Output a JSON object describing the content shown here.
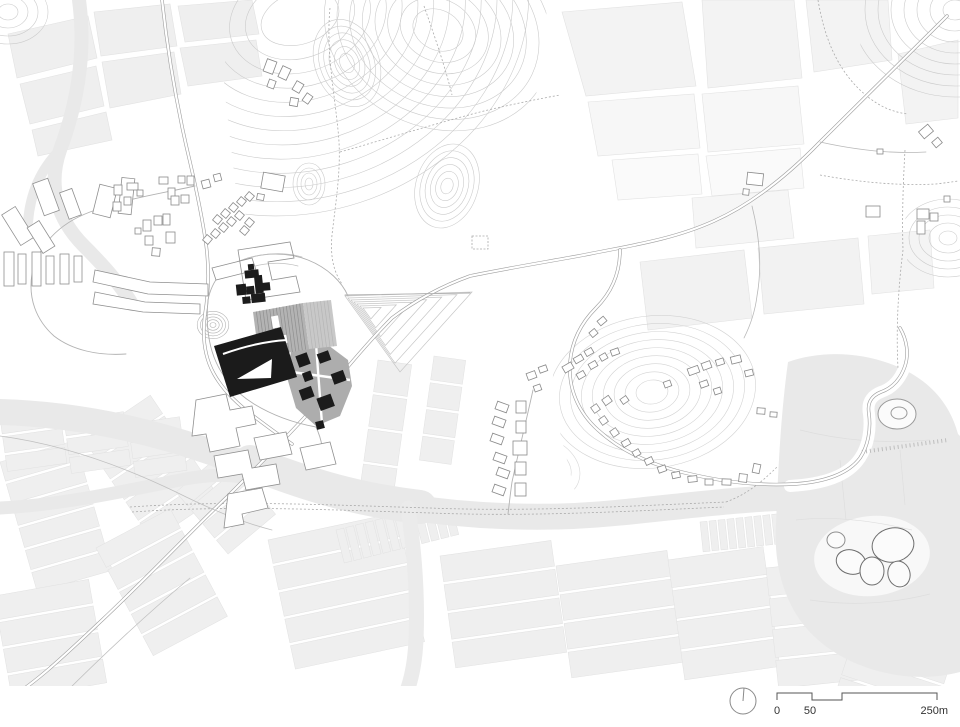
{
  "title": "architectural-site-plan",
  "scale_bar": {
    "zero": "0",
    "fifty": "50",
    "max": "250m",
    "north_icon": "north-arrow-circle-icon"
  },
  "colors": {
    "ink": "#1c1c1c",
    "roof_gray": "#b3b3b3",
    "roof_gray_light": "#c8c8c8",
    "pad_gray": "#a9a9a9",
    "field": "#efefef",
    "field_light": "#f5f5f5",
    "water": "#e9e9e9",
    "contour": "#cbcbcb",
    "road": "#9e9e9e",
    "outline": "#8a8a8a",
    "text": "#333333",
    "white": "#ffffff"
  },
  "map": {
    "houses": [
      [
        113,
        202,
        8,
        9,
        0
      ],
      [
        124,
        197,
        7,
        8,
        0
      ],
      [
        114,
        185,
        8,
        10,
        0
      ],
      [
        127,
        183,
        11,
        7,
        0
      ],
      [
        137,
        190,
        6,
        6,
        0
      ],
      [
        159,
        177,
        9,
        7,
        0
      ],
      [
        168,
        188,
        7,
        11,
        0
      ],
      [
        178,
        176,
        7,
        7,
        0
      ],
      [
        187,
        176,
        7,
        9,
        0
      ],
      [
        171,
        196,
        8,
        9,
        0
      ],
      [
        181,
        195,
        8,
        8,
        0
      ],
      [
        202,
        180,
        8,
        8,
        -15
      ],
      [
        214,
        174,
        7,
        7,
        -15
      ],
      [
        143,
        220,
        8,
        11,
        0
      ],
      [
        154,
        216,
        8,
        9,
        0
      ],
      [
        163,
        214,
        7,
        11,
        0
      ],
      [
        145,
        236,
        8,
        9,
        0
      ],
      [
        166,
        232,
        9,
        11,
        0
      ],
      [
        152,
        248,
        8,
        8,
        5
      ],
      [
        135,
        228,
        6,
        6,
        0
      ],
      [
        204,
        236,
        7,
        7,
        40
      ],
      [
        212,
        230,
        7,
        7,
        40
      ],
      [
        220,
        224,
        7,
        7,
        40
      ],
      [
        228,
        218,
        7,
        7,
        40
      ],
      [
        236,
        212,
        7,
        7,
        40
      ],
      [
        214,
        216,
        7,
        7,
        40
      ],
      [
        222,
        210,
        7,
        7,
        40
      ],
      [
        230,
        204,
        7,
        7,
        40
      ],
      [
        238,
        198,
        7,
        7,
        40
      ],
      [
        246,
        193,
        7,
        7,
        40
      ],
      [
        246,
        219,
        7,
        7,
        40
      ],
      [
        241,
        227,
        7,
        7,
        40
      ],
      [
        265,
        60,
        10,
        13,
        20
      ],
      [
        280,
        67,
        9,
        12,
        25
      ],
      [
        294,
        82,
        8,
        10,
        30
      ],
      [
        290,
        98,
        8,
        8,
        10
      ],
      [
        304,
        94,
        7,
        9,
        35
      ],
      [
        268,
        80,
        7,
        8,
        20
      ],
      [
        262,
        174,
        22,
        16,
        10
      ],
      [
        257,
        194,
        7,
        6,
        10
      ],
      [
        866,
        206,
        14,
        11,
        0
      ],
      [
        877,
        149,
        6,
        5,
        0
      ],
      [
        917,
        209,
        12,
        10,
        0
      ],
      [
        917,
        221,
        8,
        13,
        0
      ],
      [
        930,
        213,
        8,
        8,
        0
      ],
      [
        920,
        127,
        12,
        9,
        -40
      ],
      [
        933,
        139,
        8,
        7,
        -40
      ],
      [
        944,
        196,
        6,
        6,
        0
      ],
      [
        747,
        173,
        16,
        12,
        6
      ],
      [
        743,
        189,
        6,
        6,
        6
      ],
      [
        496,
        403,
        12,
        8,
        20
      ],
      [
        493,
        418,
        12,
        8,
        20
      ],
      [
        491,
        435,
        12,
        8,
        20
      ],
      [
        494,
        454,
        12,
        8,
        20
      ],
      [
        497,
        469,
        12,
        8,
        20
      ],
      [
        493,
        486,
        12,
        8,
        20
      ],
      [
        516,
        401,
        10,
        12,
        0
      ],
      [
        516,
        421,
        10,
        12,
        0
      ],
      [
        513,
        441,
        14,
        14,
        0
      ],
      [
        515,
        462,
        11,
        13,
        0
      ],
      [
        515,
        483,
        11,
        13,
        0
      ],
      [
        527,
        372,
        9,
        7,
        -20
      ],
      [
        539,
        366,
        8,
        6,
        -20
      ],
      [
        534,
        385,
        7,
        6,
        -20
      ],
      [
        563,
        364,
        10,
        7,
        -30
      ],
      [
        574,
        356,
        9,
        6,
        -30
      ],
      [
        585,
        349,
        8,
        6,
        -30
      ],
      [
        577,
        372,
        8,
        6,
        -30
      ],
      [
        589,
        362,
        8,
        6,
        -30
      ],
      [
        600,
        354,
        7,
        6,
        -30
      ],
      [
        611,
        349,
        8,
        6,
        -20
      ],
      [
        592,
        405,
        7,
        7,
        -35
      ],
      [
        600,
        417,
        7,
        7,
        -35
      ],
      [
        611,
        429,
        7,
        7,
        -35
      ],
      [
        603,
        397,
        8,
        7,
        -35
      ],
      [
        621,
        397,
        7,
        6,
        -35
      ],
      [
        622,
        440,
        8,
        6,
        -30
      ],
      [
        633,
        450,
        7,
        6,
        -30
      ],
      [
        645,
        458,
        8,
        6,
        -25
      ],
      [
        658,
        466,
        8,
        6,
        -20
      ],
      [
        672,
        472,
        8,
        6,
        -12
      ],
      [
        688,
        476,
        9,
        6,
        -6
      ],
      [
        705,
        479,
        8,
        6,
        0
      ],
      [
        722,
        479,
        9,
        6,
        2
      ],
      [
        739,
        474,
        8,
        8,
        6
      ],
      [
        753,
        464,
        7,
        9,
        12
      ],
      [
        688,
        367,
        11,
        7,
        -20
      ],
      [
        702,
        362,
        9,
        7,
        -20
      ],
      [
        716,
        359,
        8,
        6,
        -18
      ],
      [
        731,
        356,
        10,
        7,
        -14
      ],
      [
        745,
        370,
        8,
        6,
        -14
      ],
      [
        700,
        381,
        8,
        6,
        -20
      ],
      [
        714,
        388,
        7,
        6,
        -18
      ],
      [
        664,
        381,
        7,
        6,
        -20
      ],
      [
        598,
        318,
        8,
        6,
        -40
      ],
      [
        590,
        330,
        7,
        6,
        -40
      ],
      [
        757,
        408,
        8,
        6,
        4
      ],
      [
        770,
        412,
        7,
        5,
        4
      ]
    ],
    "contour_sets": [
      {
        "cx": 300,
        "cy": 18,
        "rx": 40,
        "ry": 26,
        "sx": 16,
        "sy": 14,
        "n": 13,
        "rot": -18,
        "clip": "hill"
      },
      {
        "cx": 347,
        "cy": 63,
        "rx": 7,
        "ry": 10,
        "sx": 5,
        "sy": 7,
        "n": 6,
        "rot": -20,
        "clip": "hill"
      },
      {
        "cx": 447,
        "cy": 186,
        "rx": 6,
        "ry": 8,
        "sx": 5,
        "sy": 7,
        "n": 6,
        "rot": 18,
        "clip": "hill"
      },
      {
        "cx": 309,
        "cy": 184,
        "rx": 4,
        "ry": 6,
        "sx": 4,
        "sy": 5,
        "n": 4,
        "rot": 0,
        "clip": "hill"
      },
      {
        "cx": 438,
        "cy": 30,
        "rx": 26,
        "ry": 20,
        "sx": 13,
        "sy": 11,
        "n": 8,
        "rot": 25,
        "clip": "hill"
      },
      {
        "cx": 955,
        "cy": 10,
        "rx": 12,
        "ry": 10,
        "sx": 13,
        "sy": 11,
        "n": 8,
        "rot": 0,
        "clip": "ne"
      },
      {
        "cx": 652,
        "cy": 392,
        "rx": 16,
        "ry": 12,
        "sx": 11,
        "sy": 8,
        "n": 9,
        "rot": -8,
        "clip": "ehill",
        "stroke": "#d3d3d3"
      },
      {
        "cx": 948,
        "cy": 238,
        "rx": 9,
        "ry": 7,
        "sx": 10,
        "sy": 8,
        "n": 5,
        "rot": 0,
        "clip": "redge"
      },
      {
        "cx": 213,
        "cy": 325,
        "rx": 3,
        "ry": 2.5,
        "sx": 3.2,
        "sy": 2.8,
        "n": 5,
        "rot": 0,
        "stroke": "#b3b3b3"
      },
      {
        "cx": 8,
        "cy": 12,
        "rx": 10,
        "ry": 8,
        "sx": 10,
        "sy": 8,
        "n": 4,
        "rot": 0,
        "clip": "tl"
      },
      {
        "cx": 540,
        "cy": 468,
        "rx": 14,
        "ry": 10,
        "sx": 9,
        "sy": 7,
        "n": 4,
        "rot": 20,
        "clip": "ehill",
        "stroke": "#d8d8d8"
      }
    ],
    "terrace": {
      "outer": [
        [
          345,
          296
        ],
        [
          472,
          292
        ],
        [
          400,
          372
        ]
      ],
      "inner": [
        366,
        310
      ],
      "n": 7
    },
    "strip_groups": [
      [
        0,
        462,
        78,
        20,
        6,
        3,
        -16,
        "v"
      ],
      [
        84,
        440,
        80,
        22,
        5,
        3,
        -34,
        "v"
      ],
      [
        -6,
        596,
        96,
        24,
        4,
        3,
        -10,
        "v"
      ],
      [
        96,
        548,
        84,
        22,
        5,
        3,
        -28,
        "v"
      ],
      [
        176,
        492,
        62,
        18,
        4,
        3,
        -40,
        "v"
      ],
      [
        268,
        540,
        132,
        24,
        5,
        3,
        -12,
        "v"
      ],
      [
        440,
        556,
        112,
        26,
        4,
        3,
        -8,
        "v"
      ],
      [
        556,
        566,
        112,
        26,
        4,
        3,
        -8,
        "v"
      ],
      [
        668,
        560,
        96,
        28,
        4,
        3,
        -8,
        "v"
      ],
      [
        766,
        568,
        92,
        28,
        4,
        3,
        -6,
        "v"
      ],
      [
        862,
        612,
        100,
        20,
        4,
        3,
        18,
        "v"
      ],
      [
        378,
        360,
        34,
        32,
        4,
        3,
        8,
        "v"
      ],
      [
        434,
        356,
        32,
        24,
        4,
        3,
        8,
        "v"
      ],
      [
        336,
        530,
        8,
        34,
        12,
        2,
        -14,
        "h"
      ],
      [
        700,
        522,
        7,
        30,
        16,
        2,
        -6,
        "h"
      ],
      [
        0,
        418,
        60,
        16,
        3,
        3,
        -8,
        "v"
      ],
      [
        64,
        420,
        60,
        16,
        3,
        3,
        -8,
        "v"
      ],
      [
        128,
        424,
        52,
        16,
        3,
        3,
        -8,
        "v"
      ]
    ],
    "ponds": [
      [
        893,
        545,
        21,
        17,
        -12,
        "#6e6e6e"
      ],
      [
        851,
        562,
        15,
        12,
        18,
        "#6e6e6e"
      ],
      [
        872,
        571,
        12,
        14,
        0,
        "#6e6e6e"
      ],
      [
        899,
        574,
        11,
        13,
        -15,
        "#6e6e6e"
      ],
      [
        836,
        540,
        9,
        8,
        0,
        "#8f8f8f"
      ],
      [
        897,
        414,
        19,
        15,
        0,
        "#9a9a9a"
      ],
      [
        899,
        413,
        8,
        6,
        0,
        "#9a9a9a"
      ]
    ],
    "roof_stripes": {
      "main": {
        "top": [
          [
            253,
            312
          ],
          [
            303,
            303
          ]
        ],
        "bottom": [
          [
            259,
            358
          ],
          [
            309,
            349
          ]
        ],
        "n": 15,
        "stroke": "#8f8f8f"
      },
      "ext": {
        "top": [
          [
            303,
            303
          ],
          [
            331,
            300
          ]
        ],
        "bottom": [
          [
            309,
            349
          ],
          [
            337,
            346
          ]
        ],
        "n": 8,
        "stroke": "#b5b5b5"
      }
    }
  }
}
